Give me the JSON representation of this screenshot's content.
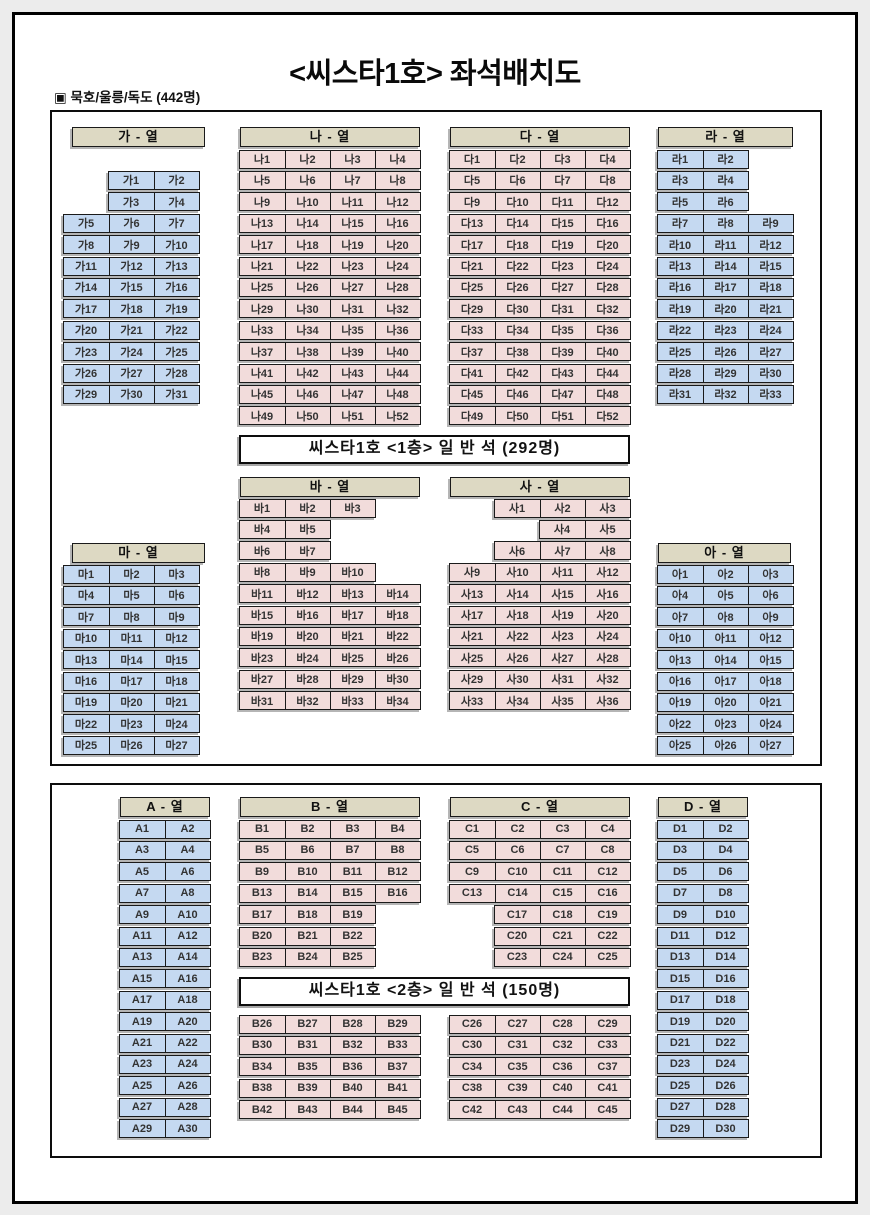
{
  "title": "<씨스타1호> 좌석배치도",
  "subtitle": "▣ 묵호/울릉/독도 (442명)",
  "colors": {
    "seat_blue": "#c5d9f1",
    "seat_pink": "#f2dcdb",
    "header_tan": "#ddd9c3",
    "border": "#1a1a1a"
  },
  "deck1": {
    "banner": "씨스타1호  <1층>  일 반 석  (292명)"
  },
  "deck2": {
    "banner": "씨스타1호  <2층>  일 반 석  (150명)"
  },
  "sections": [
    {
      "id": "ga",
      "header": "가 - 열",
      "color": "seat_blue",
      "rows": [
        [
          null,
          "가1",
          "가2"
        ],
        [
          null,
          "가3",
          "가4"
        ],
        [
          "가5",
          "가6",
          "가7"
        ],
        [
          "가8",
          "가9",
          "가10"
        ],
        [
          "가11",
          "가12",
          "가13"
        ],
        [
          "가14",
          "가15",
          "가16"
        ],
        [
          "가17",
          "가18",
          "가19"
        ],
        [
          "가20",
          "가21",
          "가22"
        ],
        [
          "가23",
          "가24",
          "가25"
        ],
        [
          "가26",
          "가27",
          "가28"
        ],
        [
          "가29",
          "가30",
          "가31"
        ]
      ]
    },
    {
      "id": "na",
      "header": "나 - 열",
      "color": "seat_pink",
      "rows": [
        [
          "나1",
          "나2",
          "나3",
          "나4"
        ],
        [
          "나5",
          "나6",
          "나7",
          "나8"
        ],
        [
          "나9",
          "나10",
          "나11",
          "나12"
        ],
        [
          "나13",
          "나14",
          "나15",
          "나16"
        ],
        [
          "나17",
          "나18",
          "나19",
          "나20"
        ],
        [
          "나21",
          "나22",
          "나23",
          "나24"
        ],
        [
          "나25",
          "나26",
          "나27",
          "나28"
        ],
        [
          "나29",
          "나30",
          "나31",
          "나32"
        ],
        [
          "나33",
          "나34",
          "나35",
          "나36"
        ],
        [
          "나37",
          "나38",
          "나39",
          "나40"
        ],
        [
          "나41",
          "나42",
          "나43",
          "나44"
        ],
        [
          "나45",
          "나46",
          "나47",
          "나48"
        ],
        [
          "나49",
          "나50",
          "나51",
          "나52"
        ]
      ]
    },
    {
      "id": "da",
      "header": "다 - 열",
      "color": "seat_pink",
      "rows": [
        [
          "다1",
          "다2",
          "다3",
          "다4"
        ],
        [
          "다5",
          "다6",
          "다7",
          "다8"
        ],
        [
          "다9",
          "다10",
          "다11",
          "다12"
        ],
        [
          "다13",
          "다14",
          "다15",
          "다16"
        ],
        [
          "다17",
          "다18",
          "다19",
          "다20"
        ],
        [
          "다21",
          "다22",
          "다23",
          "다24"
        ],
        [
          "다25",
          "다26",
          "다27",
          "다28"
        ],
        [
          "다29",
          "다30",
          "다31",
          "다32"
        ],
        [
          "다33",
          "다34",
          "다35",
          "다36"
        ],
        [
          "다37",
          "다38",
          "다39",
          "다40"
        ],
        [
          "다41",
          "다42",
          "다43",
          "다44"
        ],
        [
          "다45",
          "다46",
          "다47",
          "다48"
        ],
        [
          "다49",
          "다50",
          "다51",
          "다52"
        ]
      ]
    },
    {
      "id": "ra",
      "header": "라 - 열",
      "color": "seat_blue",
      "rows": [
        [
          "라1",
          "라2",
          null
        ],
        [
          "라3",
          "라4",
          null
        ],
        [
          "라5",
          "라6",
          null
        ],
        [
          "라7",
          "라8",
          "라9"
        ],
        [
          "라10",
          "라11",
          "라12"
        ],
        [
          "라13",
          "라14",
          "라15"
        ],
        [
          "라16",
          "라17",
          "라18"
        ],
        [
          "라19",
          "라20",
          "라21"
        ],
        [
          "라22",
          "라23",
          "라24"
        ],
        [
          "라25",
          "라26",
          "라27"
        ],
        [
          "라28",
          "라29",
          "라30"
        ],
        [
          "라31",
          "라32",
          "라33"
        ]
      ]
    },
    {
      "id": "ba",
      "header": "바 - 열",
      "color": "seat_pink",
      "rows": [
        [
          "바1",
          "바2",
          "바3",
          null
        ],
        [
          "바4",
          "바5",
          null,
          null
        ],
        [
          "바6",
          "바7",
          null,
          null
        ],
        [
          "바8",
          "바9",
          "바10",
          null
        ],
        [
          "바11",
          "바12",
          "바13",
          "바14"
        ],
        [
          "바15",
          "바16",
          "바17",
          "바18"
        ],
        [
          "바19",
          "바20",
          "바21",
          "바22"
        ],
        [
          "바23",
          "바24",
          "바25",
          "바26"
        ],
        [
          "바27",
          "바28",
          "바29",
          "바30"
        ],
        [
          "바31",
          "바32",
          "바33",
          "바34"
        ]
      ]
    },
    {
      "id": "sa",
      "header": "사 - 열",
      "color": "seat_pink",
      "rows": [
        [
          null,
          "사1",
          "사2",
          "사3"
        ],
        [
          null,
          null,
          "사4",
          "사5"
        ],
        [
          null,
          "사6",
          "사7",
          "사8"
        ],
        [
          "사9",
          "사10",
          "사11",
          "사12"
        ],
        [
          "사13",
          "사14",
          "사15",
          "사16"
        ],
        [
          "사17",
          "사18",
          "사19",
          "사20"
        ],
        [
          "사21",
          "사22",
          "사23",
          "사24"
        ],
        [
          "사25",
          "사26",
          "사27",
          "사28"
        ],
        [
          "사29",
          "사30",
          "사31",
          "사32"
        ],
        [
          "사33",
          "사34",
          "사35",
          "사36"
        ]
      ]
    },
    {
      "id": "ma",
      "header": "마 - 열",
      "color": "seat_blue",
      "rows": [
        [
          "마1",
          "마2",
          "마3"
        ],
        [
          "마4",
          "마5",
          "마6"
        ],
        [
          "마7",
          "마8",
          "마9"
        ],
        [
          "마10",
          "마11",
          "마12"
        ],
        [
          "마13",
          "마14",
          "마15"
        ],
        [
          "마16",
          "마17",
          "마18"
        ],
        [
          "마19",
          "마20",
          "마21"
        ],
        [
          "마22",
          "마23",
          "마24"
        ],
        [
          "마25",
          "마26",
          "마27"
        ]
      ]
    },
    {
      "id": "ah",
      "header": "아 - 열",
      "color": "seat_blue",
      "rows": [
        [
          "아1",
          "아2",
          "아3"
        ],
        [
          "아4",
          "아5",
          "아6"
        ],
        [
          "아7",
          "아8",
          "아9"
        ],
        [
          "아10",
          "아11",
          "아12"
        ],
        [
          "아13",
          "아14",
          "아15"
        ],
        [
          "아16",
          "아17",
          "아18"
        ],
        [
          "아19",
          "아20",
          "아21"
        ],
        [
          "아22",
          "아23",
          "아24"
        ],
        [
          "아25",
          "아26",
          "아27"
        ]
      ]
    },
    {
      "id": "A",
      "header": "A - 열",
      "color": "seat_blue",
      "rows": [
        [
          "A1",
          "A2"
        ],
        [
          "A3",
          "A4"
        ],
        [
          "A5",
          "A6"
        ],
        [
          "A7",
          "A8"
        ],
        [
          "A9",
          "A10"
        ],
        [
          "A11",
          "A12"
        ],
        [
          "A13",
          "A14"
        ],
        [
          "A15",
          "A16"
        ],
        [
          "A17",
          "A18"
        ],
        [
          "A19",
          "A20"
        ],
        [
          "A21",
          "A22"
        ],
        [
          "A23",
          "A24"
        ],
        [
          "A25",
          "A26"
        ],
        [
          "A27",
          "A28"
        ],
        [
          "A29",
          "A30"
        ]
      ]
    },
    {
      "id": "B",
      "header": "B - 열",
      "color": "seat_pink",
      "rows": [
        [
          "B1",
          "B2",
          "B3",
          "B4"
        ],
        [
          "B5",
          "B6",
          "B7",
          "B8"
        ],
        [
          "B9",
          "B10",
          "B11",
          "B12"
        ],
        [
          "B13",
          "B14",
          "B15",
          "B16"
        ],
        [
          "B17",
          "B18",
          "B19",
          null
        ],
        [
          "B20",
          "B21",
          "B22",
          null
        ],
        [
          "B23",
          "B24",
          "B25",
          null
        ]
      ]
    },
    {
      "id": "C",
      "header": "C - 열",
      "color": "seat_pink",
      "rows": [
        [
          "C1",
          "C2",
          "C3",
          "C4"
        ],
        [
          "C5",
          "C6",
          "C7",
          "C8"
        ],
        [
          "C9",
          "C10",
          "C11",
          "C12"
        ],
        [
          "C13",
          "C14",
          "C15",
          "C16"
        ],
        [
          null,
          "C17",
          "C18",
          "C19"
        ],
        [
          null,
          "C20",
          "C21",
          "C22"
        ],
        [
          null,
          "C23",
          "C24",
          "C25"
        ]
      ]
    },
    {
      "id": "B2",
      "header": null,
      "color": "seat_pink",
      "rows": [
        [
          "B26",
          "B27",
          "B28",
          "B29"
        ],
        [
          "B30",
          "B31",
          "B32",
          "B33"
        ],
        [
          "B34",
          "B35",
          "B36",
          "B37"
        ],
        [
          "B38",
          "B39",
          "B40",
          "B41"
        ],
        [
          "B42",
          "B43",
          "B44",
          "B45"
        ]
      ]
    },
    {
      "id": "C2",
      "header": null,
      "color": "seat_pink",
      "rows": [
        [
          "C26",
          "C27",
          "C28",
          "C29"
        ],
        [
          "C30",
          "C31",
          "C32",
          "C33"
        ],
        [
          "C34",
          "C35",
          "C36",
          "C37"
        ],
        [
          "C38",
          "C39",
          "C40",
          "C41"
        ],
        [
          "C42",
          "C43",
          "C44",
          "C45"
        ]
      ]
    },
    {
      "id": "D",
      "header": "D - 열",
      "color": "seat_blue",
      "rows": [
        [
          "D1",
          "D2"
        ],
        [
          "D3",
          "D4"
        ],
        [
          "D5",
          "D6"
        ],
        [
          "D7",
          "D8"
        ],
        [
          "D9",
          "D10"
        ],
        [
          "D11",
          "D12"
        ],
        [
          "D13",
          "D14"
        ],
        [
          "D15",
          "D16"
        ],
        [
          "D17",
          "D18"
        ],
        [
          "D19",
          "D20"
        ],
        [
          "D21",
          "D22"
        ],
        [
          "D23",
          "D24"
        ],
        [
          "D25",
          "D26"
        ],
        [
          "D27",
          "D28"
        ],
        [
          "D29",
          "D30"
        ]
      ]
    }
  ]
}
